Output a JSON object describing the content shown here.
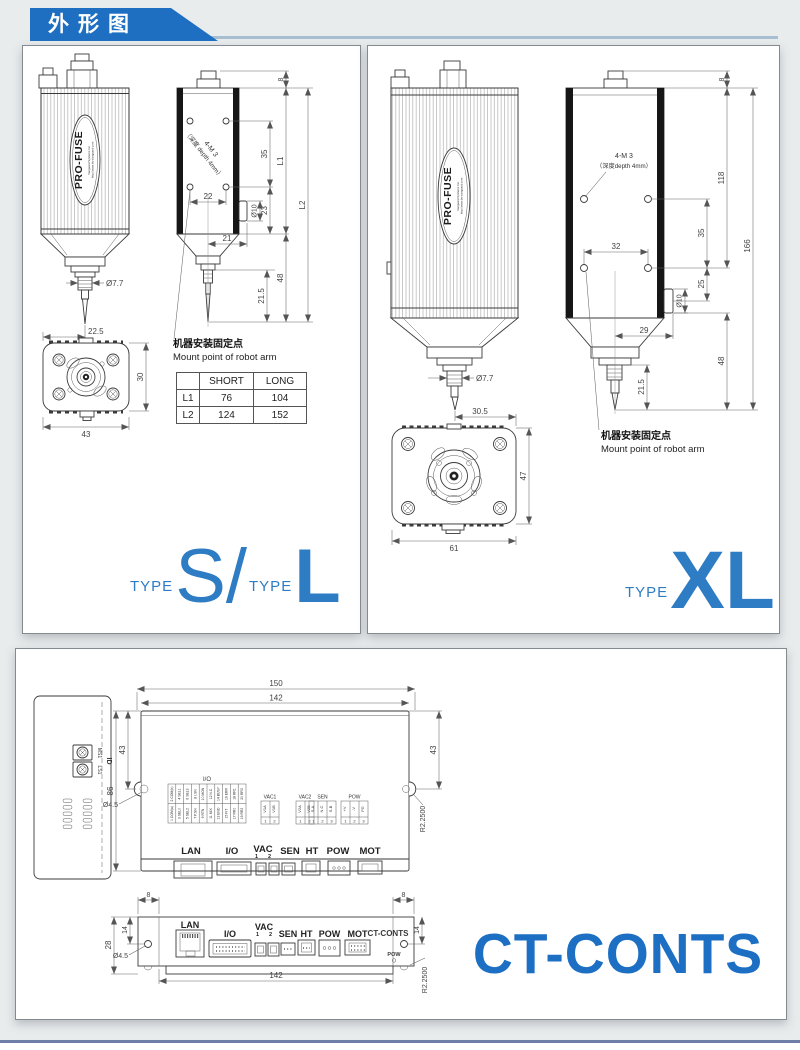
{
  "colors": {
    "brand_blue": "#1e6fc2",
    "type_blue": "#2e7cc3",
    "ct_logo_blue": "#1d6fc3"
  },
  "header": {
    "title": "外形图"
  },
  "shared": {
    "brand": "PRO-FUSE",
    "brand_sub": "Vanguard Systems Inc.",
    "brand_url": "http://www.by-vanguard.com",
    "mount_cn": "机器安装固定点",
    "mount_en": "Mount point of robot arm",
    "type_word": "TYPE"
  },
  "panel_sl": {
    "note1": "4-M 3",
    "note2": "（深度 depth 4mm）",
    "dims": {
      "top8": "8",
      "v35": "35",
      "l1": "L1",
      "h22": "22",
      "v23": "23",
      "dia10": "Ø10",
      "l2": "L2",
      "h21": "21",
      "v48": "48",
      "v21_5": "21.5",
      "dia7_7": "Ø7.7",
      "tip": "22.5",
      "fl_h": "30",
      "fl_w": "43"
    },
    "table": {
      "headers": [
        "",
        "SHORT",
        "LONG"
      ],
      "rows": [
        [
          "L1",
          "76",
          "104"
        ],
        [
          "L2",
          "124",
          "152"
        ]
      ]
    },
    "big1": "S",
    "slash": "/",
    "big2": "L"
  },
  "panel_xl": {
    "note1": "4-M 3",
    "note2": "（深度depth 4mm）",
    "dims": {
      "top8": "8",
      "v118": "118",
      "v35": "35",
      "v166": "166",
      "h32": "32",
      "v25": "25",
      "dia10": "Ø10",
      "h29": "29",
      "v48": "48",
      "v21_5": "21.5",
      "dia7_7": "Ø7.7",
      "tip": "30.5",
      "fl_h": "47",
      "fl_w": "61"
    },
    "big": "XL"
  },
  "panel_ct": {
    "side": {
      "id": "ID",
      "ms1": "MS1",
      "ls1": "LS1"
    },
    "top": {
      "dims": {
        "w150": "150",
        "w142": "142",
        "l43": "43",
        "h86": "86",
        "dia": "Ø4.5",
        "r43": "43",
        "notch": "R2.2500"
      },
      "io_label": "I/O",
      "io_top": [
        "2 COM(b)",
        "4 SEL1",
        "6 SEL3",
        "8 I.SN",
        "10 MON",
        "12 N.C",
        "14 BUSY",
        "16 ERR",
        "18 RR1",
        "20 RR3"
      ],
      "io_bottom": [
        "1 COM(a)",
        "3 SEL0",
        "5 SEL2",
        "7 P.SN",
        "9 RTN",
        "11 MIX",
        "13 END",
        "15 FIT",
        "17 RR0",
        "19 RR2"
      ],
      "tables": [
        {
          "label": "VAC1",
          "pins": [
            "V1A",
            "V1B"
          ],
          "nums": [
            "1",
            "2"
          ]
        },
        {
          "label": "VAC2",
          "pins": [
            "V2A",
            "V2B"
          ],
          "nums": [
            "1",
            "2"
          ]
        },
        {
          "label": "SEN",
          "pins": [
            "S-A",
            "N.C",
            "S-B"
          ],
          "nums": [
            "1",
            "2",
            "3"
          ]
        },
        {
          "label": "POW",
          "pins": [
            "+V",
            "-V",
            "FG"
          ],
          "nums": [
            "1",
            "2",
            "3"
          ]
        }
      ],
      "ports": [
        "LAN",
        "I/O",
        "VAC",
        "SEN",
        "HT",
        "POW",
        "MOT"
      ],
      "vac1": "1",
      "vac2": "2"
    },
    "front": {
      "dims": {
        "e8": "8",
        "s14": "14",
        "h28": "28",
        "dia": "Ø4.5",
        "w142": "142",
        "notch": "R2.2500"
      },
      "ports": [
        "LAN",
        "I/O",
        "VAC",
        "SEN",
        "HT",
        "POW",
        "MOT"
      ],
      "vac1": "1",
      "vac2": "2",
      "print": "CT-CONTS",
      "led": "POW"
    },
    "logo": "CT-CONTS"
  }
}
